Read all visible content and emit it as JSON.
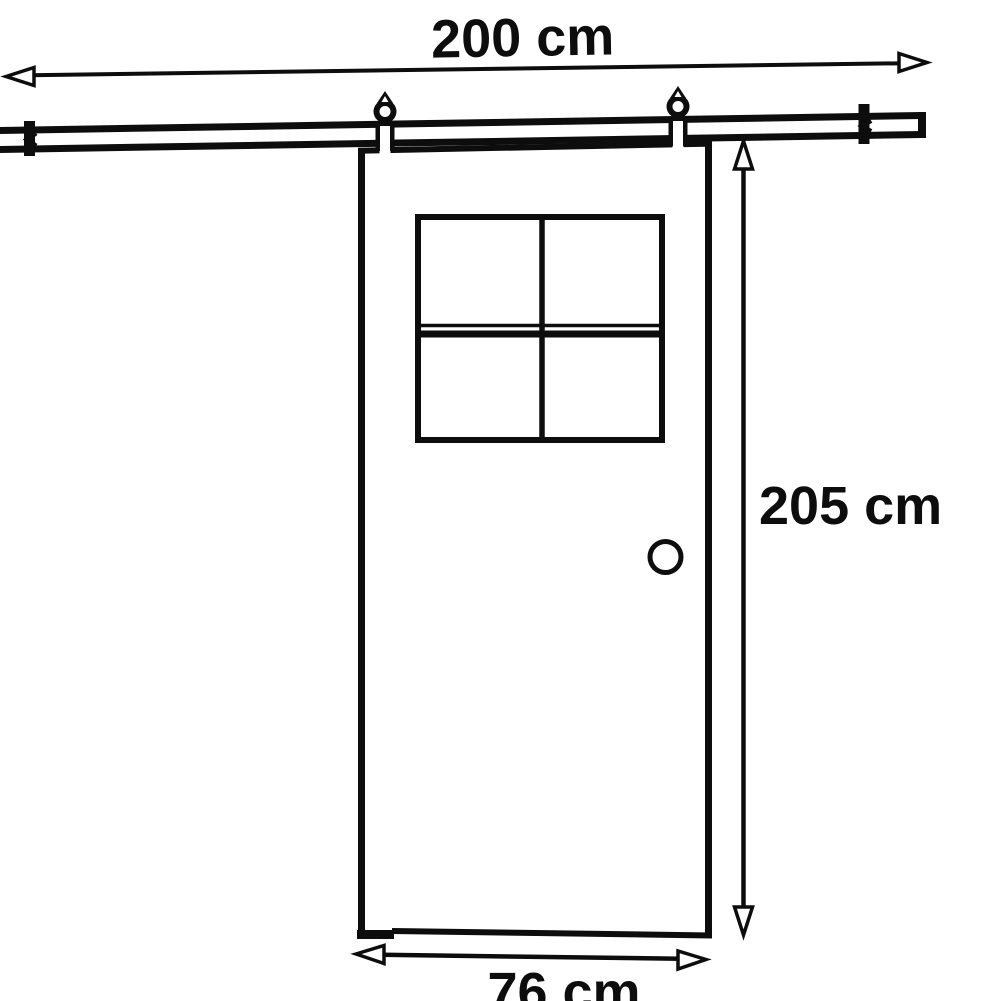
{
  "diagram": {
    "type": "sliding-barn-door-dimension-drawing",
    "labels": {
      "rail_width": "200 cm",
      "door_height": "205 cm",
      "door_width": "76 cm"
    },
    "components": {
      "rail": "top sliding track with two wall brackets and end cap",
      "hangers": "two roller hangers connecting door to track",
      "door": "door panel with four-pane window, round handle, bottom guide step"
    },
    "colors": {
      "ink": "#0d0d0d",
      "background": "#ffffff"
    }
  }
}
